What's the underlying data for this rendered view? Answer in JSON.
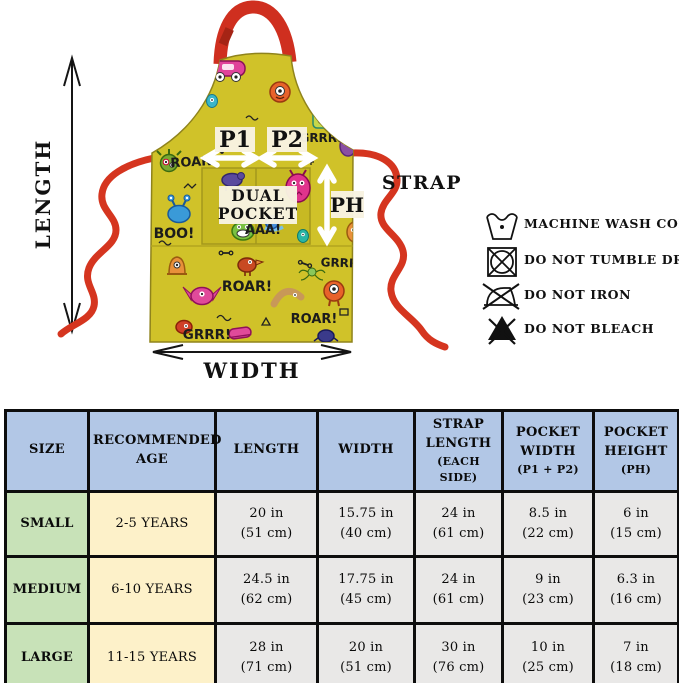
{
  "colors": {
    "apron_yellow": "#d0c229",
    "pocket_yellow": "#c7b923",
    "strap_red": "#d5351f",
    "table_header_blue": "#b2c7e6",
    "size_col_green": "#c8e2b8",
    "age_col_cream": "#fdf1c9",
    "data_col_gray": "#e9e8e7",
    "overlay_box_cream": "#f8f3e1"
  },
  "apron_diagram": {
    "dimensions": {
      "length": "LENGTH",
      "width": "WIDTH",
      "strap": "STRAP",
      "p1": "P1",
      "p2": "P2",
      "ph": "PH",
      "dual_line1": "DUAL",
      "dual_line2": "POCKET"
    },
    "fabric_texts": [
      "ROAR!",
      "GRRR!",
      "BOO!",
      "AAA!",
      "GRRR!",
      "ROAR!",
      "ROAR!",
      "GRRR!"
    ]
  },
  "care_instructions": [
    {
      "icon": "machine-wash-cold-icon",
      "label": "MACHINE WASH COLD"
    },
    {
      "icon": "do-not-tumble-dry-icon",
      "label": "DO NOT TUMBLE DRY"
    },
    {
      "icon": "do-not-iron-icon",
      "label": "DO NOT IRON"
    },
    {
      "icon": "do-not-bleach-icon",
      "label": "DO NOT BLEACH"
    }
  ],
  "size_table": {
    "headers": [
      {
        "main": "SIZE",
        "sub": ""
      },
      {
        "main": "RECOMMENDED\nAGE",
        "sub": ""
      },
      {
        "main": "LENGTH",
        "sub": ""
      },
      {
        "main": "WIDTH",
        "sub": ""
      },
      {
        "main": "STRAP\nLENGTH",
        "sub": "(EACH SIDE)"
      },
      {
        "main": "POCKET\nWIDTH",
        "sub": "(P1 + P2)"
      },
      {
        "main": "POCKET\nHEIGHT",
        "sub": "(PH)"
      }
    ],
    "rows": [
      {
        "size": "SMALL",
        "age": "2-5 YEARS",
        "length": "20 in\n(51 cm)",
        "width": "15.75 in\n(40 cm)",
        "strap": "24 in\n(61 cm)",
        "pocket_width": "8.5 in\n(22 cm)",
        "pocket_height": "6 in\n(15 cm)"
      },
      {
        "size": "MEDIUM",
        "age": "6-10 YEARS",
        "length": "24.5 in\n(62 cm)",
        "width": "17.75 in\n(45 cm)",
        "strap": "24 in\n(61 cm)",
        "pocket_width": "9 in\n(23 cm)",
        "pocket_height": "6.3 in\n(16 cm)"
      },
      {
        "size": "LARGE",
        "age": "11-15 YEARS",
        "length": "28 in\n(71 cm)",
        "width": "20 in\n(51 cm)",
        "strap": "30 in\n(76 cm)",
        "pocket_width": "10 in\n(25 cm)",
        "pocket_height": "7 in\n(18 cm)"
      }
    ]
  }
}
